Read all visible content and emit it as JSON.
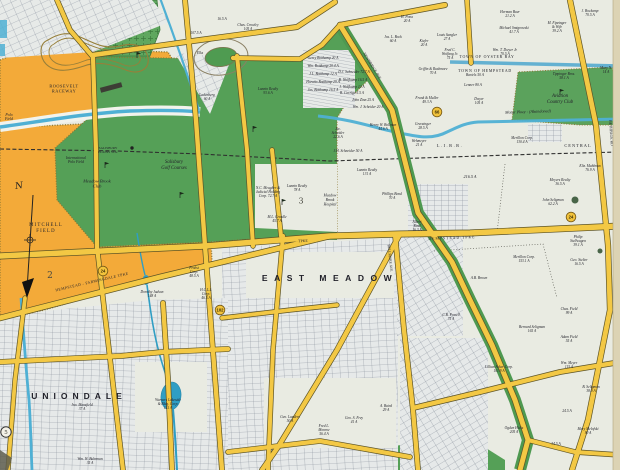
{
  "map": {
    "colors": {
      "paper": "#e9ebe2",
      "field_orange": "#f3aa39",
      "golf_green": "#55a057",
      "cemetery_green": "#5fa75f",
      "water_blue": "#4fb0d4",
      "pond_blue": "#2f9ec4",
      "road_yellow": "#f3c844",
      "parkway_green": "#4e9950",
      "ink": "#23232b"
    },
    "feature_labels": [
      {
        "t": "EAST MEADOW",
        "x": 330,
        "y": 279,
        "s": 8.5,
        "ls": 6.5,
        "sp": 1
      },
      {
        "t": "UNIONDALE",
        "x": 79,
        "y": 397,
        "s": 8.5,
        "ls": 5,
        "sp": 1
      },
      {
        "t": "MITCHELL\nFIELD",
        "x": 46,
        "y": 228,
        "s": 4.8,
        "ls": 1.2
      },
      {
        "t": "ROOSEVELT\nRACEWAY",
        "x": 64,
        "y": 89,
        "s": 4.3,
        "ls": 0.5
      },
      {
        "t": "Salisbury\nGolf Courses",
        "x": 174,
        "y": 165,
        "s": 4.8,
        "i": 1
      },
      {
        "t": "Meadow Brook\nClub",
        "x": 97,
        "y": 184,
        "s": 4.5,
        "i": 1
      },
      {
        "t": "International\nPolo Field",
        "x": 76,
        "y": 160,
        "s": 3.8,
        "i": 1
      },
      {
        "t": "Polo\nField",
        "x": 9,
        "y": 117,
        "s": 3.8,
        "i": 1
      },
      {
        "t": "Aviation\nCountry Club",
        "x": 560,
        "y": 99,
        "s": 4.8,
        "i": 1
      },
      {
        "t": "Meadow\nBrook\nHospital",
        "x": 330,
        "y": 200,
        "s": 3.7,
        "i": 1
      },
      {
        "t": "Motor Pkwy - (Abandoned)",
        "x": 528,
        "y": 112,
        "s": 4.2,
        "i": 1,
        "r": -2
      },
      {
        "t": "L.I.R.R.",
        "x": 450,
        "y": 146,
        "s": 4.4,
        "ls": 1.5
      },
      {
        "t": "CENTRAL",
        "x": 578,
        "y": 146,
        "s": 4.4,
        "ls": 1
      },
      {
        "t": "TOWN OF OYSTER BAY",
        "x": 487,
        "y": 57,
        "s": 3.9,
        "ls": 0.7,
        "c": "#394663"
      },
      {
        "t": "TOWN OF HEMPSTEAD",
        "x": 485,
        "y": 71,
        "s": 3.9,
        "ls": 0.7,
        "c": "#394663"
      },
      {
        "t": "SALISBURY\nPLAINS STA.",
        "x": 108,
        "y": 150,
        "s": 3.4
      },
      {
        "t": "TPKE",
        "x": 303,
        "y": 241,
        "s": 3.8,
        "r": -3
      },
      {
        "t": "HEMPSTEAD TPKE",
        "x": 452,
        "y": 238,
        "s": 3.8,
        "r": -2,
        "ls": 1
      },
      {
        "t": "HEMPSTEAD - FARMINGDALE TPKE",
        "x": 92,
        "y": 282,
        "s": 3.8,
        "r": -13,
        "ls": 0.4
      },
      {
        "t": "NEWBRIDGE AVE",
        "x": 372,
        "y": 66,
        "s": 3.8,
        "r": 58
      },
      {
        "t": "BETHPAGE RD",
        "x": 611,
        "y": 133,
        "s": 3.8,
        "r": 86
      },
      {
        "t": "BELLMORE AVE",
        "x": 390,
        "y": 258,
        "s": 3.6,
        "r": 84
      }
    ],
    "parcel_labels": [
      {
        "t": "107.5 A",
        "x": 196,
        "y": 33
      },
      {
        "t": "Chas. Crowley\n105 A",
        "x": 248,
        "y": 27
      },
      {
        "t": "Elks",
        "x": 200,
        "y": 53
      },
      {
        "t": "Ladenberg\n60 A",
        "x": 207,
        "y": 97
      },
      {
        "t": "Lannin Realty\n93.6 A",
        "x": 268,
        "y": 91
      },
      {
        "t": "16.5 A",
        "x": 222,
        "y": 19
      },
      {
        "t": "Gerry Bottkamp 20 A",
        "x": 323,
        "y": 58
      },
      {
        "t": "Wm. Bottkamp 20.4 A",
        "x": 323,
        "y": 66
      },
      {
        "t": "J.L. Bottkamp 12 A",
        "x": 323,
        "y": 74
      },
      {
        "t": "Horatio Bottkamp 29 A",
        "x": 323,
        "y": 82
      },
      {
        "t": "Jos. Bottkamp 16.5 A",
        "x": 323,
        "y": 90
      },
      {
        "t": "D.J. Schneider 72.7 A",
        "x": 354,
        "y": 72
      },
      {
        "t": "B. Wolfkamp 16.5 A",
        "x": 353,
        "y": 80
      },
      {
        "t": "J. Wolfkamp 12 A",
        "x": 352,
        "y": 87
      },
      {
        "t": "B. Corriga 5.5 A",
        "x": 352,
        "y": 93
      },
      {
        "t": "John Zinn 25 A",
        "x": 363,
        "y": 100
      },
      {
        "t": "Wm. J. Scheider 20 A",
        "x": 368,
        "y": 107
      },
      {
        "t": "Jos. L. Bock\n60 A",
        "x": 393,
        "y": 39
      },
      {
        "t": "Kiefer\n20 A",
        "x": 424,
        "y": 43
      },
      {
        "t": "Louis Sangler\n27 A",
        "x": 447,
        "y": 37
      },
      {
        "t": "Fred C.\nWolfang Jr.\n75 A",
        "x": 450,
        "y": 54
      },
      {
        "t": "H. Pona\n20 A",
        "x": 407,
        "y": 19
      },
      {
        "t": "Herman Baer\n21.2 A",
        "x": 510,
        "y": 14
      },
      {
        "t": "Michael Smigrowski\n41.7 A",
        "x": 514,
        "y": 30
      },
      {
        "t": "M. Fipzinger\n& Wife\n39.2 A",
        "x": 557,
        "y": 27
      },
      {
        "t": "J. Bockamp\n70.5 A",
        "x": 590,
        "y": 13
      },
      {
        "t": "Wm. T. Dwyer Jr.\n70.5 A",
        "x": 505,
        "y": 52
      },
      {
        "t": "Griffin & Rushmore\n70 A",
        "x": 433,
        "y": 71
      },
      {
        "t": "Bartels  50 A",
        "x": 475,
        "y": 75
      },
      {
        "t": "Lenner  80 A",
        "x": 473,
        "y": 85
      },
      {
        "t": "Tippinger Bros.\n58.1 A",
        "x": 564,
        "y": 76
      },
      {
        "t": "Dwyer\n105 A",
        "x": 479,
        "y": 101
      },
      {
        "t": "Frank & Muller\n49.3 A",
        "x": 427,
        "y": 100
      },
      {
        "t": "Mary N.\n14 A",
        "x": 606,
        "y": 70
      },
      {
        "t": "Jac.\nScheider\n22.6 A",
        "x": 338,
        "y": 133
      },
      {
        "t": "J.H. Schneider 50 A",
        "x": 348,
        "y": 151
      },
      {
        "t": "Henry W. Bollman\n44.6 A",
        "x": 383,
        "y": 127
      },
      {
        "t": "Greczinger\n28.5 A",
        "x": 423,
        "y": 126
      },
      {
        "t": "Wehmeyer\n21 A",
        "x": 419,
        "y": 143
      },
      {
        "t": "Merillon Corp.\n130.4 A",
        "x": 522,
        "y": 140
      },
      {
        "t": "Lannin Realty\n131 A",
        "x": 367,
        "y": 172
      },
      {
        "t": "Lannin Realty\n78 A",
        "x": 297,
        "y": 188
      },
      {
        "t": "N.C. Meagher &\nJudicial Holding\nCorp.  72.7 A",
        "x": 268,
        "y": 192
      },
      {
        "t": "M.L. Creadle\n45.7 A",
        "x": 277,
        "y": 219
      },
      {
        "t": "Phillips Bond\n70 A",
        "x": 392,
        "y": 196
      },
      {
        "t": "216.5 A",
        "x": 470,
        "y": 177,
        "s": 4.2
      },
      {
        "t": "Eliz. Mahlman\n76.9 A",
        "x": 590,
        "y": 168
      },
      {
        "t": "Meyers Realty\n36.5 A",
        "x": 560,
        "y": 182
      },
      {
        "t": "John Seligman\n62.2 A",
        "x": 553,
        "y": 202
      },
      {
        "t": "Albert\nRind\n16.3 A",
        "x": 417,
        "y": 226
      },
      {
        "t": "Dorothy Judson\n148 A",
        "x": 152,
        "y": 294
      },
      {
        "t": "Probst\nCorp.\n48.5 A",
        "x": 194,
        "y": 272
      },
      {
        "t": "H.C.L.I.\nCorp.\n46.5 A",
        "x": 206,
        "y": 294
      },
      {
        "t": "Geo. Landers\n50 A",
        "x": 290,
        "y": 419
      },
      {
        "t": "Fred L.\nMonroe\n56.4 A",
        "x": 324,
        "y": 430
      },
      {
        "t": "Geo. S. Frey\n41 A",
        "x": 354,
        "y": 420
      },
      {
        "t": "A. Baird\n29 A",
        "x": 386,
        "y": 408
      },
      {
        "t": "Merillon Corp.\n153.1 A",
        "x": 524,
        "y": 259
      },
      {
        "t": "Philip\nStellwagen\n39.1 A",
        "x": 578,
        "y": 241
      },
      {
        "t": "Geo. Stelter\n16.5 A",
        "x": 579,
        "y": 262
      },
      {
        "t": "A.B. Brown",
        "x": 479,
        "y": 278
      },
      {
        "t": "C.B. Powell\n75 A",
        "x": 451,
        "y": 317
      },
      {
        "t": "Bernard Seligman\n165 A",
        "x": 532,
        "y": 329
      },
      {
        "t": "Chas. Field\n99 A",
        "x": 569,
        "y": 311
      },
      {
        "t": "Adam Field\n55 A",
        "x": 569,
        "y": 339
      },
      {
        "t": "Wm. Meyer\n115 A",
        "x": 569,
        "y": 365
      },
      {
        "t": "24.5 A",
        "x": 567,
        "y": 411
      },
      {
        "t": "B. Seligman\n38.9 A",
        "x": 591,
        "y": 389
      },
      {
        "t": "Mary Melofski\n90 A",
        "x": 588,
        "y": 431
      },
      {
        "t": "Ogden Hicks\n205 A",
        "x": 514,
        "y": 430
      },
      {
        "t": "Lillian Acker Corp.\n101.9 A",
        "x": 499,
        "y": 369
      },
      {
        "t": "Jno. Mansfield\n37 A",
        "x": 82,
        "y": 407
      },
      {
        "t": "Wm. W. Buhrman\n35 A",
        "x": 90,
        "y": 461
      },
      {
        "t": "Warners Lakeside\n& Bldg. Corp.\n115 A",
        "x": 168,
        "y": 404
      },
      {
        "t": "34.5 A",
        "x": 556,
        "y": 444
      }
    ],
    "route_shields": [
      {
        "n": "24",
        "x": 103,
        "y": 271
      },
      {
        "n": "24",
        "x": 571,
        "y": 217
      },
      {
        "n": "66",
        "x": 437,
        "y": 112
      },
      {
        "n": "102",
        "x": 220,
        "y": 310
      }
    ],
    "plate_numbers": [
      {
        "n": "2",
        "x": 50,
        "y": 275,
        "s": 9,
        "circled": false
      },
      {
        "n": "3",
        "x": 301,
        "y": 201,
        "s": 8,
        "circled": false
      },
      {
        "n": "5",
        "x": 6,
        "y": 432,
        "s": 5.5,
        "circled": true
      }
    ],
    "golf_flags": [
      [
        137,
        58
      ],
      [
        253,
        132
      ],
      [
        105,
        168
      ],
      [
        180,
        198
      ],
      [
        282,
        205
      ],
      [
        560,
        95
      ]
    ],
    "compass": {
      "label": "N",
      "x": 19,
      "y": 186
    },
    "station": {
      "x": 132,
      "y": 148
    }
  }
}
